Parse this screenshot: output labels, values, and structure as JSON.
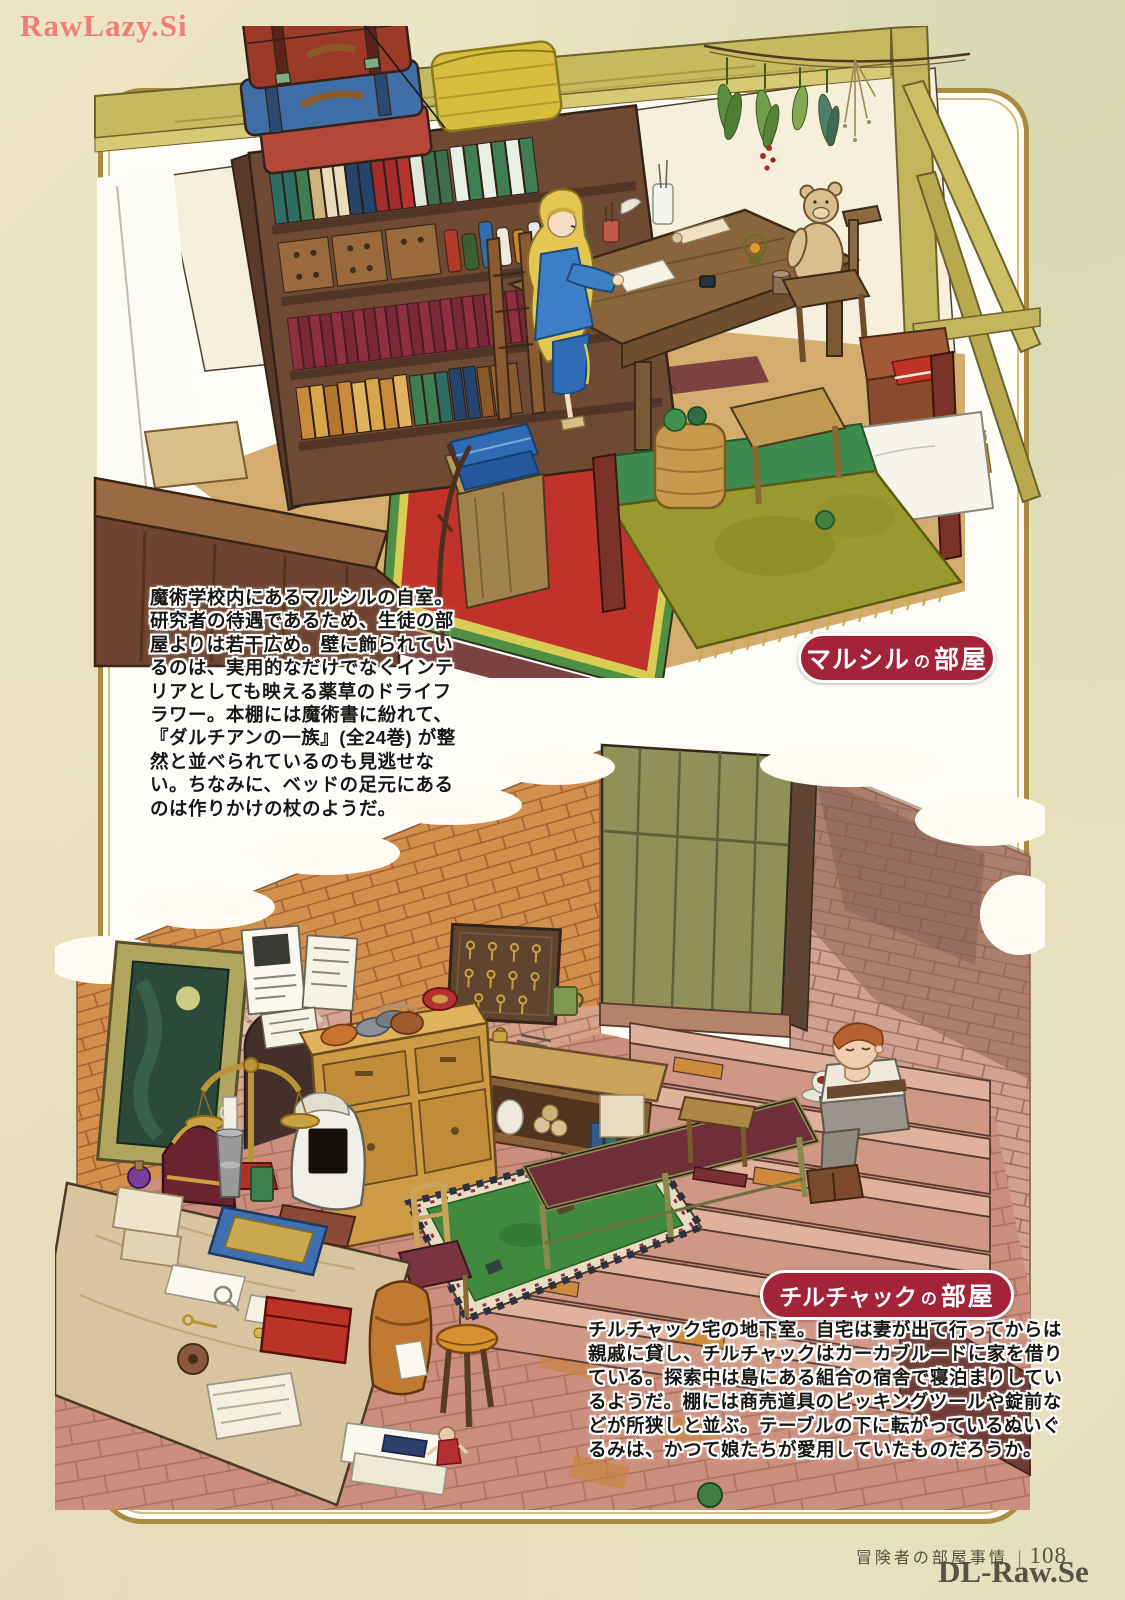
{
  "page": {
    "watermark_top_left": "RawLazy.Si",
    "watermark_bottom_right": "DL-Raw.Se",
    "footer": {
      "title": "冒険者の部屋事情",
      "divider": "|",
      "page_number": "108"
    },
    "colors": {
      "paper": "#e9e2bf",
      "frame_border": "#ab8c3e",
      "badge": "#a32338"
    }
  },
  "sections": {
    "marcille": {
      "badge_name": "マルシル",
      "badge_particle": "の",
      "badge_room": "部屋",
      "description": "魔術学校内にあるマルシルの自室。\n研究者の待遇であるため、生徒の部\n屋よりは若干広め。壁に飾られてい\nるのは、実用的なだけでなくインテ\nリアとしても映える薬草のドライフ\nラワー。本棚には魔術書に紛れて、\n『ダルチアンの一族』(全24巻) が整\n然と並べられているのも見逃せな\nい。ちなみに、ベッドの足元にある\nのは作りかけの杖のようだ。"
    },
    "chilchuck": {
      "badge_name": "チルチャック",
      "badge_particle": "の",
      "badge_room": "部屋",
      "description": "チルチャック宅の地下室。自宅は妻が出て行ってからは\n親戚に貸し、チルチャックはカーカブルードに家を借り\nている。探索中は島にある組合の宿舎で寝泊まりしてい\nるようだ。棚には商売道具のピッキングツールや錠前な\nどが所狭しと並ぶ。テーブルの下に転がっているぬいぐ\nるみは、かつて娘たちが愛用していたものだろうか。"
    }
  }
}
